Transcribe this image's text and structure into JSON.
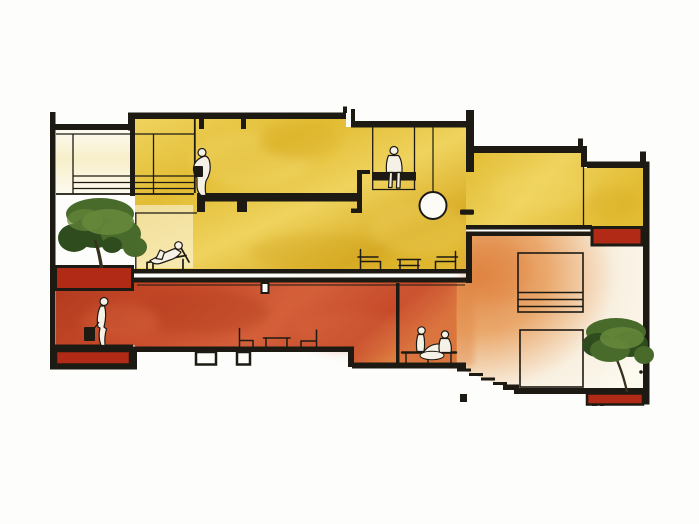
{
  "scene": {
    "kind": "architectural-section-illustration",
    "levels": [
      "upper-level-yellow",
      "lower-level-red",
      "right-wing-double-height-orange"
    ],
    "objects": [
      "left-courtyard-tree",
      "right-courtyard-tree",
      "pendant-lamp",
      "stairs",
      "planter-boxes",
      "window-frames",
      "lounge-chairs",
      "coffee-tables",
      "bench"
    ],
    "figures": [
      "figure-leaning-over-balcony",
      "figure-sitting-on-mezzanine-edge",
      "figure-reclining-on-chaise",
      "figure-walking-with-bag",
      "figure-lounging-on-bench",
      "figure-seated-on-bench"
    ]
  },
  "colors": {
    "paper": "#fdfdfb",
    "ink": "#1d1a13",
    "yellow_main": "#e2bc33",
    "yellow_light": "#efd35e",
    "yellow_deep": "#d9ad26",
    "bay_pale": "#f7efc9",
    "bay_white": "#fdfaf0",
    "red_main": "#c64a2a",
    "red_deep": "#b23a1e",
    "red_light": "#d4603a",
    "planter_red": "#b02a15",
    "orange_main": "#df8443",
    "orange_mid": "#eaa86c",
    "orange_pale": "#f8efdf",
    "green_dark": "#2e4c1e",
    "green_mid": "#486a2b",
    "green_light": "#66883b",
    "trunk": "#36301d",
    "figure_fill": "#f5f1e6",
    "lamp_white": "#fcfbf6"
  }
}
